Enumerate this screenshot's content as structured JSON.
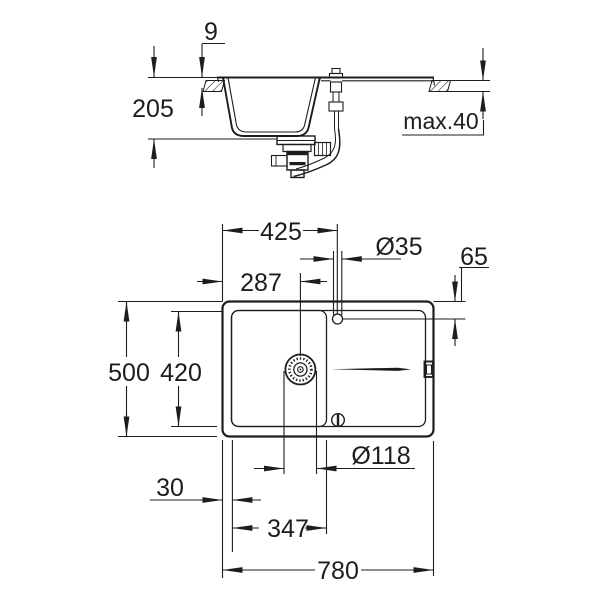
{
  "meta": {
    "drawing_type": "technical dimension drawing",
    "subject": "kitchen sink with drainer board - section view (top) and plan view (bottom)",
    "background_color": "#ffffff",
    "line_color": "#1d1d1d"
  },
  "labels": {
    "rim_height": "9",
    "bowl_depth": "205",
    "counter_thickness_max": "max.40",
    "faucet_center_from_left": "425",
    "faucet_hole_diameter": "Ø35",
    "faucet_center_from_top_edge": "65",
    "drain_center_from_left": "287",
    "overall_depth": "500",
    "inner_basin_depth": "420",
    "drain_hole_diameter": "Ø118",
    "left_rim_width": "30",
    "bowl_inner_width": "347",
    "overall_width": "780"
  }
}
